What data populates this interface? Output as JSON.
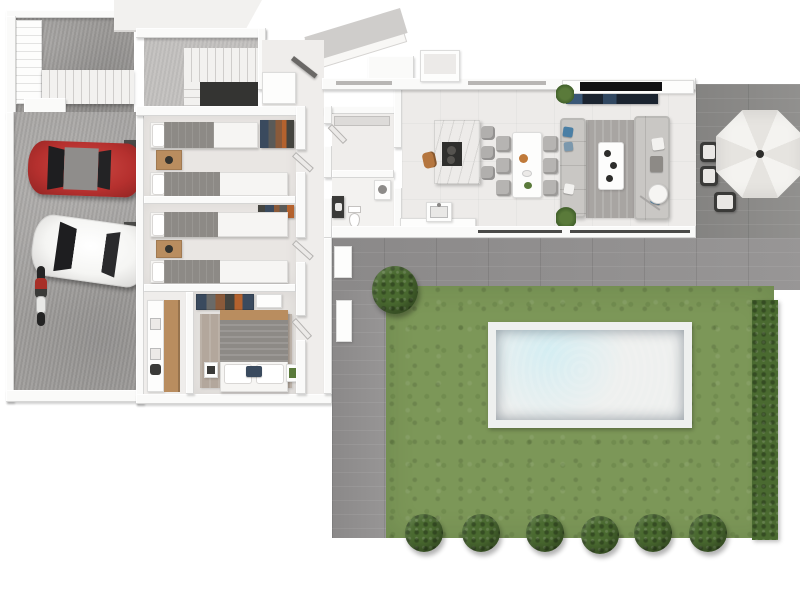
{
  "meta": {
    "title": "3D floor plan — top-down architectural render",
    "visible_text": "none"
  },
  "palette": {
    "bg": "#ffffff",
    "wall": "#fafaf9",
    "concrete": "#a5a3a1",
    "concrete-light": "#c3c1bf",
    "drive-concrete": "#9a9896",
    "floor-room": "#e9e6e3",
    "floor-hall": "#efedeb",
    "floor-living": "#edebe9",
    "plank": "#929090",
    "plank-dark": "#8b8a88",
    "grass": "#7c9758",
    "hedge": "#4a6a30",
    "pool-deck": "#eef0ef",
    "pool-deep": "#2e7e9c",
    "pool-mid": "#3e98b6",
    "pool-light": "#7cc3d6",
    "car-red": "#b5302e",
    "car-white": "#f5f5f3",
    "window-dark": "#1e1e20",
    "sofa": "#c9c7c4",
    "rug": "#a8a5a2",
    "rug-master": "#b3a79c",
    "duvet": "#8d8a86",
    "wood": "#b98d5f",
    "fixture-dark": "#3a3a38",
    "tv-black": "#111113",
    "media-navy": "#1b2430",
    "accent-blue": "#4a7fa5",
    "stool": "#b1afad",
    "umbrella-light": "#f4f3f0",
    "umbrella-shade": "#e6e4e0",
    "void": "#343432",
    "clothes-navy": "#3a4a5e",
    "clothes-orange": "#b4622e",
    "wood-dark": "#8a5a3a"
  },
  "scene": {
    "type": "3d-floor-plan-top-view",
    "areas": [
      "driveway-with-exterior-stairs",
      "garage",
      "staircase-room",
      "bedroom-1",
      "bedroom-2",
      "master-bedroom",
      "ensuite",
      "hallway",
      "closet",
      "bathroom",
      "open-plan-kitchen-dining-living",
      "window-bay",
      "side-patio",
      "south-patio",
      "garden-lawn",
      "swimming-pool"
    ],
    "vehicles": {
      "cars": [
        "red",
        "white"
      ],
      "motorcycles": 1
    },
    "furniture": {
      "twin_beds": 4,
      "double_beds": 1,
      "wardrobes": 3,
      "dining_chairs": 6,
      "bar_stools": 3,
      "sofas": 2,
      "coffee_tables": 1,
      "tv_units": 1,
      "parasols": 1,
      "outdoor_chairs": 3
    },
    "garden": {
      "perimeter_bushes": 6,
      "corner_bush": 1,
      "hedge_side": "east",
      "pool_shape": "rectangular"
    }
  }
}
